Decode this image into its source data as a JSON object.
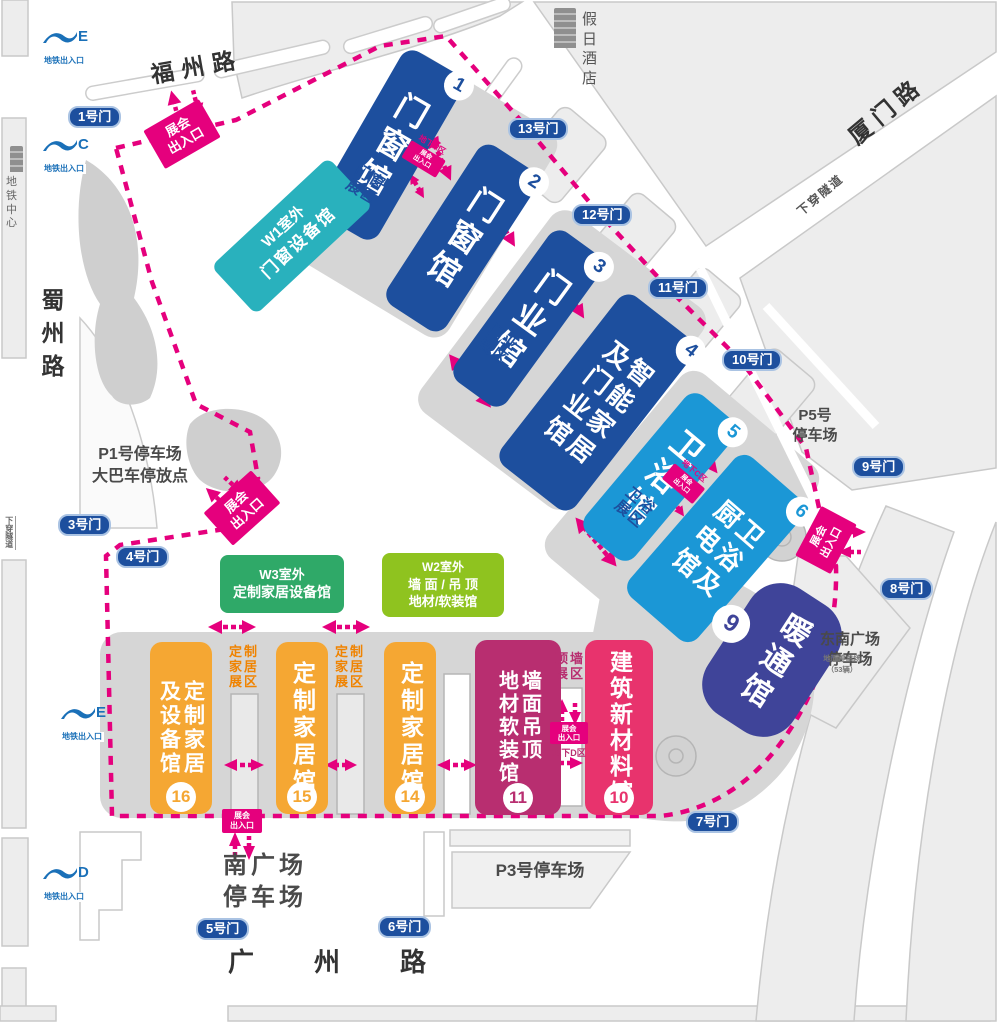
{
  "colors": {
    "accent_magenta": "#e5007d",
    "hall_deep_blue": "#1d4f9e",
    "hall_bright_blue": "#1b97d6",
    "hall_indigo": "#3f4499",
    "hall_magenta": "#b82e70",
    "hall_pink": "#e8336d",
    "hall_orange": "#f5a733",
    "outdoor_teal": "#29b1bd",
    "outdoor_green": "#2fa968",
    "outdoor_lime": "#8fc31f"
  },
  "roads": {
    "fuzhou": "福州路",
    "xiamen": "厦门路",
    "shuzhou": "蜀州路",
    "guangzhou": "广州路",
    "tunnel_ne": "下穿隧道",
    "tunnel_w": "下穿隧道"
  },
  "landmarks": {
    "hotel_1": "假日",
    "hotel_2": "酒店",
    "metro_center_1": "地铁",
    "metro_center_2": "中心"
  },
  "metro": {
    "label": "地铁出入口",
    "e_top": "E",
    "c": "C",
    "e_mid": "E",
    "d": "D"
  },
  "gates": {
    "g1": "1号门",
    "g3": "3号门",
    "g4": "4号门",
    "g5": "5号门",
    "g6": "6号门",
    "g7": "7号门",
    "g8": "8号门",
    "g9": "9号门",
    "g10": "10号门",
    "g11": "11号门",
    "g12": "12号门",
    "g13": "13号门"
  },
  "halls": {
    "h1": {
      "num": "1",
      "col1": "门窗馆"
    },
    "h2": {
      "num": "2",
      "col1": "门窗馆"
    },
    "h3": {
      "num": "3",
      "col1": "门业馆"
    },
    "h4": {
      "num": "4",
      "col1": "智能家居",
      "col2": "及门业馆"
    },
    "h5": {
      "num": "5",
      "col1": "卫浴馆"
    },
    "h6": {
      "num": "6",
      "col1": "卫浴及",
      "col2": "厨电馆"
    },
    "h9": {
      "num": "9",
      "col1": "暖通馆"
    },
    "h10": {
      "num": "10",
      "col1": "建筑新材料馆"
    },
    "h11": {
      "num": "11",
      "col1": "墙面吊顶",
      "col2": "地材软装馆"
    },
    "h14": {
      "num": "14",
      "col1": "定制家居馆"
    },
    "h15": {
      "num": "15",
      "col1": "定制家居馆"
    },
    "h16": {
      "num": "16",
      "col1": "定制家居",
      "col2": "及设备馆"
    }
  },
  "outdoor": {
    "w1_1": "W1室外",
    "w1_2": "门窗设备馆",
    "w3_1": "W3室外",
    "w3_2": "定制家居设备馆",
    "w2_1": "W2室外",
    "w2_2": "墙 面 / 吊 顶",
    "w2_3": "地材/软装馆"
  },
  "zones": {
    "mc1": "门窗",
    "mc2": "展区",
    "my1": "门业",
    "my2": "展区",
    "wy1": "卫浴",
    "wy2": "展区",
    "dz1": "定制",
    "dz2": "家居",
    "dz3": "展区",
    "dq1": "顶墙",
    "dq2": "展区"
  },
  "entrances": {
    "l1": "展会",
    "l2": "出入口",
    "ua": "地下A区",
    "uc": "地下C区",
    "ud": "地下D区"
  },
  "parking": {
    "p1_1": "P1号停车场",
    "p1_2": "大巴车停放点",
    "p3": "P3号停车场",
    "p5_1": "P5号",
    "p5_2": "停车场",
    "se_1": "东南广场",
    "se_2": "停车场",
    "ground_1": "地面停车场",
    "ground_2": "（53辆）",
    "south_1": "南广场",
    "south_2": "停车场"
  }
}
